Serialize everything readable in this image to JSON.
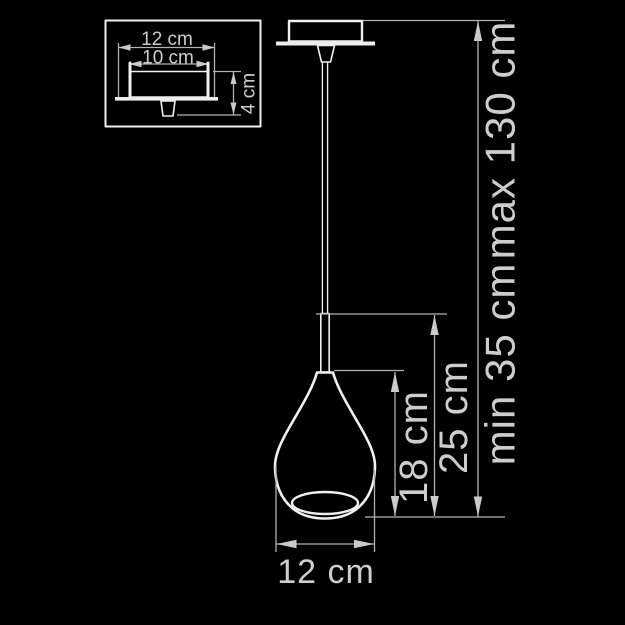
{
  "inset": {
    "width_label": "12 cm",
    "inner_width_label": "10 cm",
    "height_label": "4 cm"
  },
  "main": {
    "shade_width_label": "12 cm",
    "shade_height_label": "18 cm",
    "body_height_label": "25 cm",
    "suspension_min_label": "min 35 cm",
    "suspension_max_label": "max 130 cm"
  },
  "colors": {
    "background": "#000000",
    "outline": "#f0f0f0",
    "dimension_line": "#b2b2b2",
    "label_text": "#cdcdcd"
  }
}
